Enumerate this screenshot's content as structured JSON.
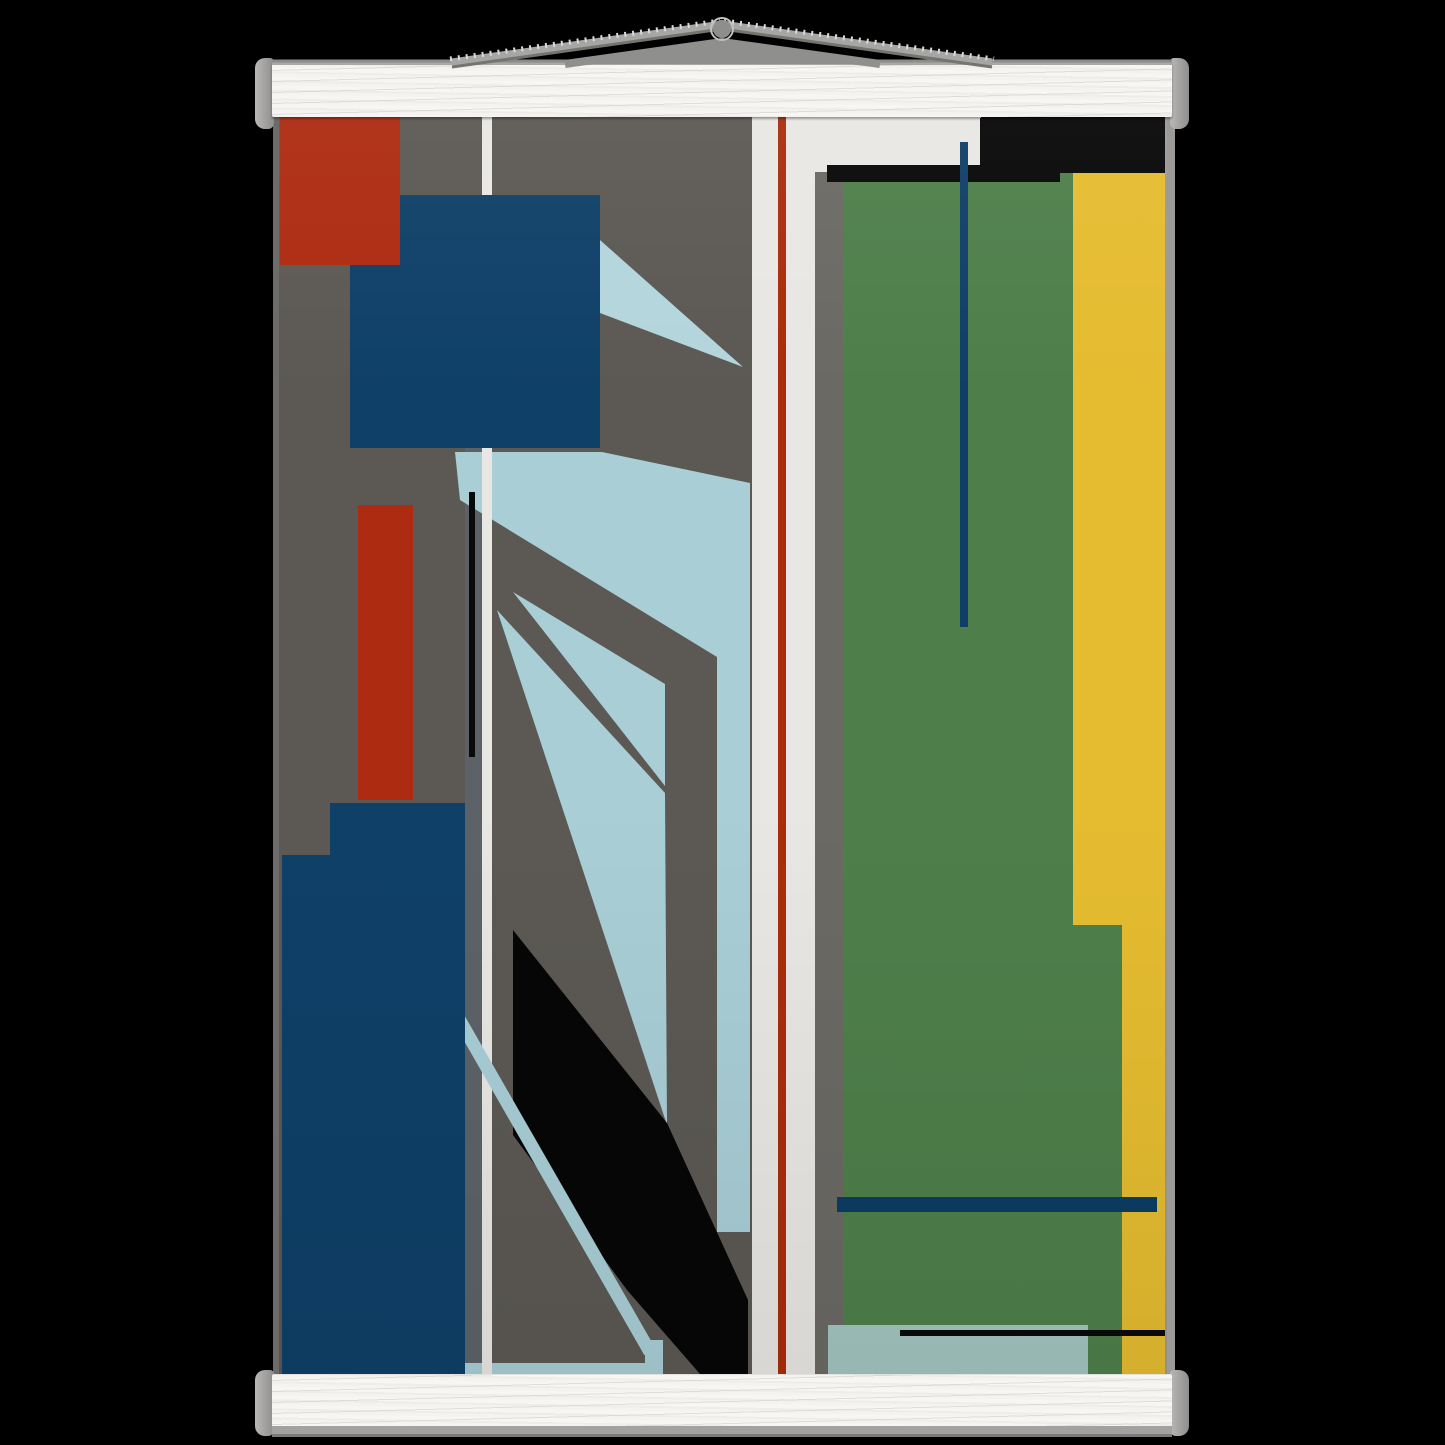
{
  "scene": {
    "background_color": "#000000",
    "kind": "poster-product-mockup"
  },
  "hanger": {
    "bar_face_color": "#f4f3f0",
    "cap_color": "#a7a6a4",
    "edge_line_color": "#8d8c8a",
    "under_shadow_color": "#a3a2a0",
    "cord": {
      "strap_color": "#a6a6a4",
      "back_color": "#8f8f8d",
      "highlight_color": "#dadad8",
      "dark_edge_color": "#75756f",
      "knob_color": "#8e8e8c",
      "knob_rim_color": "#c0c0be"
    }
  },
  "poster": {
    "x": 279,
    "y": 114,
    "width": 888,
    "height": 1260,
    "background_color": "#5c5954",
    "palette": {
      "gray": "#5c5954",
      "gray_right_column": "#6b6964",
      "slate_gray": "#5d6269",
      "white": "#e9e7e3",
      "brick_red": "#ad2b10",
      "dark_red_line": "#a92d0c",
      "navy": "#0f4068",
      "navy_dark": "#0c3c63",
      "light_blue": "#a9ced6",
      "pale_blue": "#b3d5dc",
      "teal_blue": "#a2c5bf",
      "green": "#4e7f4a",
      "yellow": "#e5bc30",
      "black": "#060606"
    },
    "shapes": [
      {
        "name": "left-gray-background",
        "type": "rect",
        "x": 0,
        "y": 0,
        "w": 473,
        "h": 1260,
        "fill": "#5c5954"
      },
      {
        "name": "white-vertical-band",
        "type": "rect",
        "x": 473,
        "y": 0,
        "w": 63,
        "h": 1260,
        "fill": "#e9e7e3"
      },
      {
        "name": "white-top-right-area",
        "type": "rect",
        "x": 473,
        "y": 0,
        "w": 229,
        "h": 59,
        "fill": "#e9e7e3"
      },
      {
        "name": "right-gray-column",
        "type": "rect",
        "x": 536,
        "y": 58,
        "w": 28,
        "h": 1202,
        "fill": "#6b6964"
      },
      {
        "name": "green-band",
        "type": "rect",
        "x": 564,
        "y": 59,
        "w": 230,
        "h": 1201,
        "fill": "#4e7f4a"
      },
      {
        "name": "green-band-lower",
        "type": "rect",
        "x": 794,
        "y": 811,
        "w": 49,
        "h": 449,
        "fill": "#4e7f4a"
      },
      {
        "name": "yellow-band",
        "type": "rect",
        "x": 794,
        "y": 59,
        "w": 92,
        "h": 752,
        "fill": "#e5bc30"
      },
      {
        "name": "yellow-band-narrow",
        "type": "rect",
        "x": 843,
        "y": 811,
        "w": 43,
        "h": 449,
        "fill": "#e5bc30"
      },
      {
        "name": "slate-gray-sliver",
        "type": "rect",
        "x": 186,
        "y": 334,
        "w": 17,
        "h": 926,
        "fill": "#5d6269"
      },
      {
        "name": "lightblue-main-band",
        "type": "polygon",
        "points": "176,338 323,338 471,369 471,1118 438,1118 438,543 181,386",
        "fill": "#a9ced6"
      },
      {
        "name": "lightblue-thin-ray",
        "type": "polygon",
        "points": "234,478 386,570 386,672",
        "fill": "#a9ced6"
      },
      {
        "name": "lightblue-wide-ray",
        "type": "polygon",
        "points": "218,496 386,679 388,1011",
        "fill": "#a9ced6"
      },
      {
        "name": "lightblue-top-triangle",
        "type": "polygon",
        "points": "321,126 464,253 321,199",
        "fill": "#b3d5dc"
      },
      {
        "name": "black-diagonal-shape",
        "type": "polygon",
        "points": "234,816 388,1009 469,1186 469,1260 421,1260 348,1176 234,1021",
        "fill": "#060606"
      },
      {
        "name": "lightblue-bottom-bar",
        "type": "rect",
        "x": 168,
        "y": 1249,
        "w": 216,
        "h": 11,
        "fill": "#a9ced6"
      },
      {
        "name": "white-thin-stripe",
        "type": "rect",
        "x": 203,
        "y": 0,
        "w": 10,
        "h": 1260,
        "fill": "#e9e7e3"
      },
      {
        "name": "lightblue-diagonal-stripe",
        "type": "line",
        "x1": 145,
        "y1": 844,
        "x2": 371,
        "y2": 1238,
        "stroke": "#a9ced6",
        "width": 13
      },
      {
        "name": "lightblue-elbow",
        "type": "rect",
        "x": 366,
        "y": 1226,
        "w": 18,
        "h": 34,
        "fill": "#a9ced6"
      },
      {
        "name": "navy-square",
        "type": "rect",
        "x": 71,
        "y": 81,
        "w": 250,
        "h": 253,
        "fill": "#0f4068"
      },
      {
        "name": "red-rectangle-top",
        "type": "rect",
        "x": 1,
        "y": 1,
        "w": 120,
        "h": 150,
        "fill": "#ad2b10"
      },
      {
        "name": "red-bar",
        "type": "rect",
        "x": 79,
        "y": 391,
        "w": 55,
        "h": 295,
        "fill": "#ad2b10"
      },
      {
        "name": "navy-bottom-rectangle",
        "type": "polygon",
        "points": "51,689 186,689 186,1260 3,1260 3,741 51,741",
        "fill": "#0f4068"
      },
      {
        "name": "black-vertical-line",
        "type": "rect",
        "x": 190,
        "y": 378,
        "w": 6,
        "h": 265,
        "fill": "#0a0a0a"
      },
      {
        "name": "black-top-right-rectangle",
        "type": "rect",
        "x": 701,
        "y": 4,
        "w": 185,
        "h": 55,
        "fill": "#070707"
      },
      {
        "name": "black-horizontal-bar",
        "type": "rect",
        "x": 548,
        "y": 51,
        "w": 233,
        "h": 17,
        "fill": "#070707"
      },
      {
        "name": "red-vertical-line",
        "type": "rect",
        "x": 499,
        "y": 0,
        "w": 8,
        "h": 1260,
        "fill": "#a92d0c"
      },
      {
        "name": "navy-vertical-line",
        "type": "rect",
        "x": 681,
        "y": 28,
        "w": 8,
        "h": 485,
        "fill": "#0f3f68"
      },
      {
        "name": "navy-horizontal-bar",
        "type": "rect",
        "x": 558,
        "y": 1083,
        "w": 320,
        "h": 15,
        "fill": "#0c3c63"
      },
      {
        "name": "teal-bottom-rectangle",
        "type": "rect",
        "x": 549,
        "y": 1211,
        "w": 260,
        "h": 49,
        "fill": "#a2c5bf"
      },
      {
        "name": "black-bottom-line",
        "type": "rect",
        "x": 621,
        "y": 1216,
        "w": 265,
        "h": 6,
        "fill": "#0a0a0a"
      }
    ]
  }
}
